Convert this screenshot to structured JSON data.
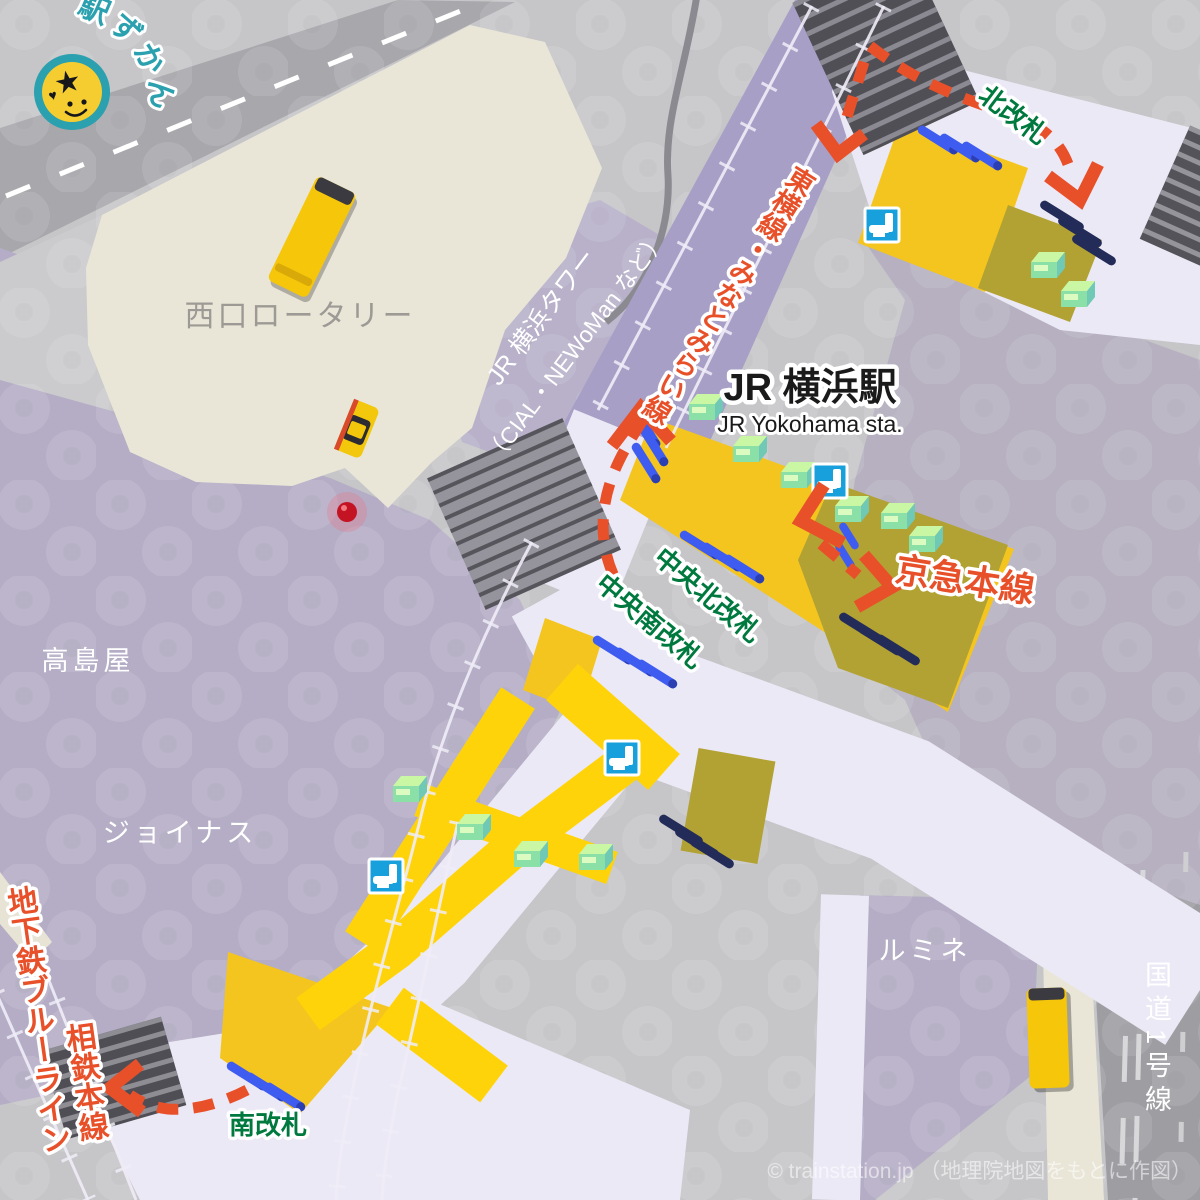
{
  "logo": {
    "brand": "駅ずかん"
  },
  "station": {
    "title_ja": "JR 横浜駅",
    "title_en": "JR Yokohama sta."
  },
  "gates": {
    "north": "北改札",
    "central_north": "中央北改札",
    "central_south": "中央南改札",
    "south": "南改札"
  },
  "railways": {
    "toyoko_minatomirai": "東横線・みなとみらい線",
    "keikyu_main": "京急本線",
    "sotetsu_main": "相鉄本線",
    "subway_blue_line": "地下鉄ブルーライン",
    "route1": "国道1号線"
  },
  "places": {
    "west_rotary": "西口ロータリー",
    "takashimaya": "高島屋",
    "joinus": "ジョイナス",
    "lumine": "ルミネ",
    "jr_tower": "JR 横浜タワー",
    "jr_tower_sub": "（CIAL・NEWoMan など）"
  },
  "footer": {
    "credit": "© trainstation.jp （地理院地図をもとに作図）"
  },
  "icons": {
    "toilet": "toilet-icon",
    "stairs": "stairs-icon",
    "ticket_machine": "ticket-machine-icon",
    "ticket_gate": "ticket-gate-icon",
    "signal": "signal-light-icon",
    "bus": "bus-icon",
    "taxi": "taxi-icon",
    "brand_face": "smiley-star-logo-icon"
  },
  "colors": {
    "route_accent": "#E8502A",
    "gate_label_green": "#00793F",
    "station_area_yellow": "#F4C51F",
    "path_yellow": "#FFD30A",
    "keikyu_area_olive": "#B2A233",
    "concourse_white": "#ECE9F6",
    "building_purple": "#B4ADC5",
    "railway_band": "#A89FC6",
    "road_grey": "#A8A7AC",
    "plaza_cream": "#E9E6D8",
    "brand_teal": "#2BA0AE",
    "gate_bar_blue": "#3F5CF0",
    "gate_bar_navy": "#232C59"
  }
}
